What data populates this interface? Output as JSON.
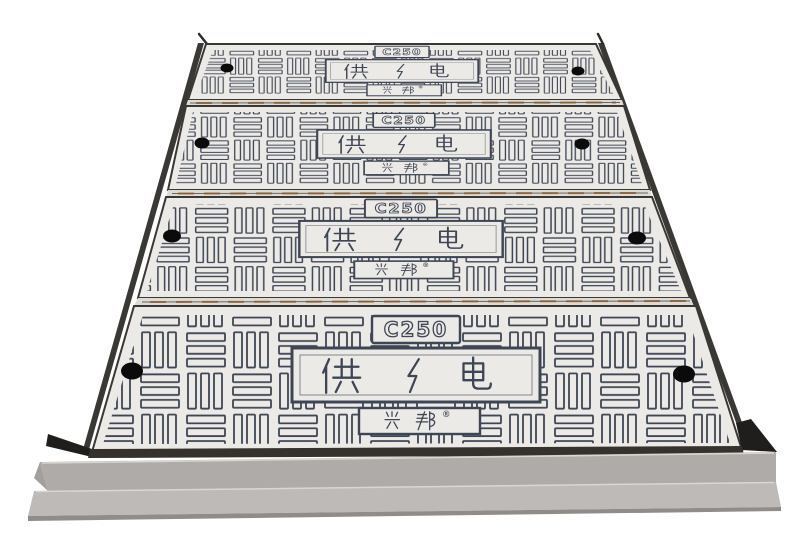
{
  "scene": {
    "type": "product-photo",
    "subject": "Stack of four composite power trench covers seated in a steel frame",
    "panels_visible": 4,
    "bolt_holes_per_panel": 2
  },
  "panel": {
    "rating_label": "C250",
    "center_text": "供电",
    "center_left_char": "供",
    "center_divider_icon": "lightning-bolt",
    "center_right_char": "电",
    "brand_text": "兴邦",
    "registered_mark": "®"
  },
  "colors": {
    "surface": "#ECEAE6",
    "groove": "#3E4554",
    "edge": "#3A3834",
    "hole": "#0B0B0B",
    "joint": "#DEDAD4",
    "rust": "#8A5C33",
    "frame_face": "#AFABA8",
    "frame_flange": "#BEBAB7",
    "frame_strip": "#908C89",
    "background": "#FFFFFF"
  }
}
